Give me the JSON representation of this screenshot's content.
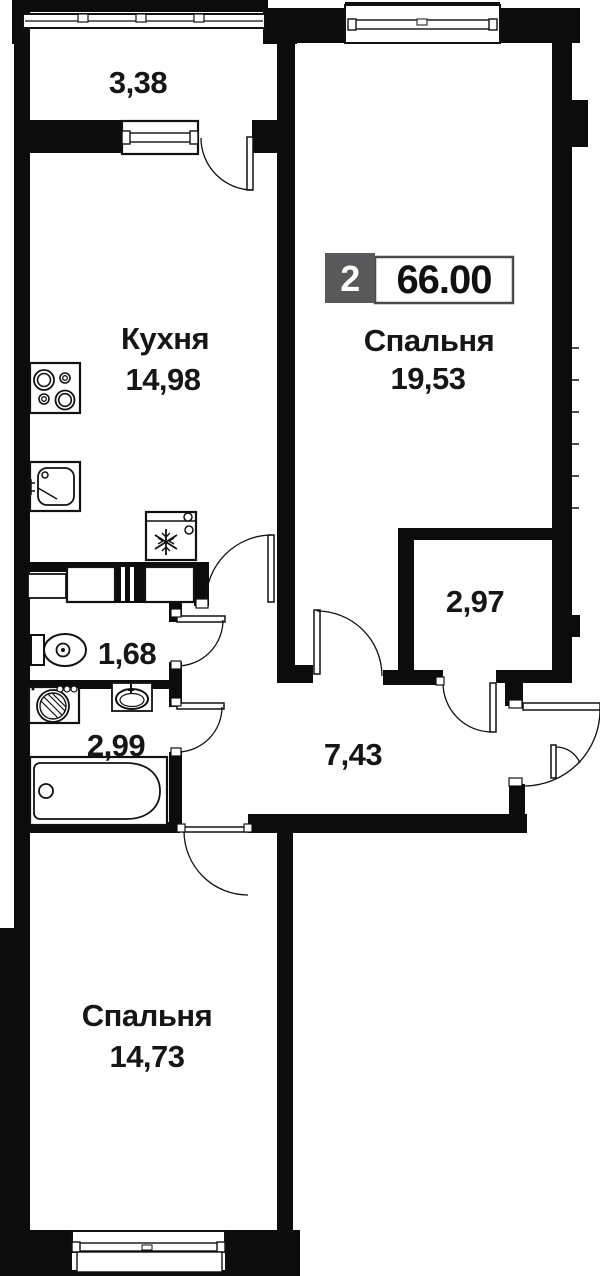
{
  "floor_plan": {
    "badge": {
      "rooms_count": "2",
      "total_area": "66.00"
    },
    "rooms": {
      "balcony": {
        "area": "3,38"
      },
      "kitchen": {
        "name": "Кухня",
        "area": "14,98"
      },
      "bedroom_main": {
        "name": "Спальня",
        "area": "19,53"
      },
      "wardrobe": {
        "area": "2,97"
      },
      "wc": {
        "area": "1,68"
      },
      "bathroom": {
        "area": "2,99"
      },
      "hallway": {
        "area": "7,43"
      },
      "bedroom_second": {
        "name": "Спальня",
        "area": "14,73"
      }
    },
    "colors": {
      "wall": "#0c0c0c",
      "badge_box": "#59595b",
      "badge_number_bg": "#ffffff",
      "text": "#161616",
      "background": "#ffffff"
    },
    "icons": {
      "fridge": "snowflake-icon",
      "stove": "four-burners-icon",
      "kitchen_sink": "sink-basin-icon",
      "toilet": "toilet-icon",
      "washing_machine": "washer-drum-icon",
      "washbasin": "oval-basin-icon",
      "bathtub": "bathtub-icon",
      "doors": "door-swing-arc-icon",
      "windows": "double-frame-window-icon"
    }
  }
}
